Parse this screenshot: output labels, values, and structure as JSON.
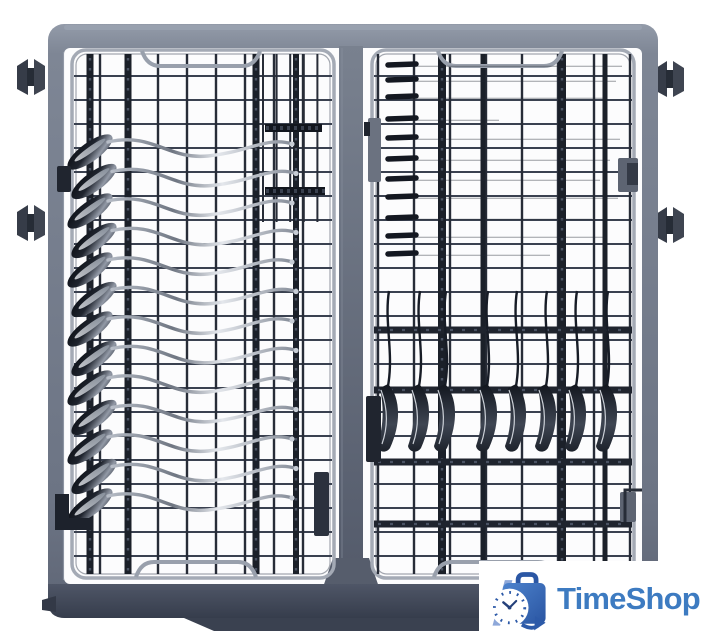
{
  "scene": {
    "description": "Top view product photo of a slate-gray dishwasher third-rack cutlery tray loaded with cutlery on a white background",
    "background_color": "#ffffff"
  },
  "rack": {
    "frame_color": "#7d8594",
    "frame_bottom_color": "#3a4150",
    "wire_color": "#272c37",
    "thick_rail_color": "#1b2029",
    "tray_outline_color": "#a4aab5",
    "center_rail_color": "#6a7281",
    "roller_color": "#363c48",
    "cutlery_dark": "#12161e",
    "cutlery_highlight": "#eef0f3",
    "left_tray": {
      "flat_spoons": 13
    },
    "right_tray": {
      "flat_knives": 11,
      "hanging_spoons": 8
    },
    "rollers": 4
  },
  "watermark": {
    "brand": "TimeShop",
    "text_color": "#3d7bc1",
    "bag_color": "#2a55a2",
    "bag_light_color": "#4d83cd",
    "stripe_color": "#8ea8d9",
    "clock_face_color": "#ffffff",
    "clock_tick_color": "#2d5aa8",
    "hand_color": "#24407a"
  }
}
